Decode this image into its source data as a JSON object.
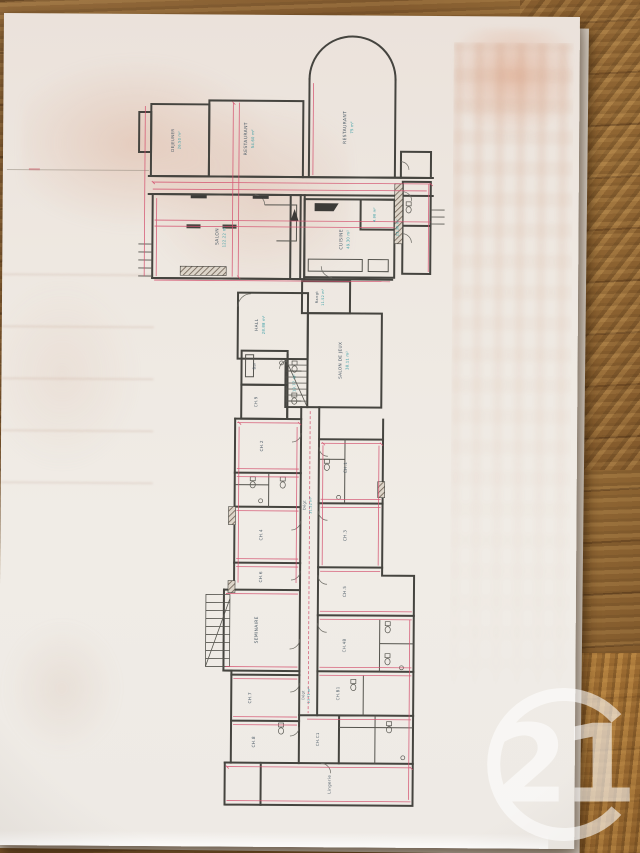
{
  "watermark": {
    "label": "21",
    "color": "#ffffff"
  },
  "plan": {
    "rooms": {
      "dejeuner": {
        "name": "DEJEUNER",
        "area": "26.50 m²"
      },
      "restaurant1": {
        "name": "RESTAURANT",
        "area": "54.60 m²"
      },
      "restaurant2": {
        "name": "RESTAURANT",
        "area": "75 m²"
      },
      "salon": {
        "name": "SALON",
        "area": "122.22 m²"
      },
      "cuisine": {
        "name": "CUISINE",
        "area": "49.30 m²"
      },
      "office_small": {
        "name": "",
        "area": "4.98 m²"
      },
      "office_corridor": {
        "name": "",
        "area": "23.36 m²"
      },
      "hall": {
        "name": "HALL",
        "area": "28.88 m²"
      },
      "rangement": {
        "name": "Rangt",
        "area": "11.52 m²"
      },
      "salon_de_jeux": {
        "name": "SALON DE JEUX",
        "area": "38.11 m²"
      },
      "degagement_escalier": {
        "name": "",
        "area": "19.77 m²"
      },
      "bar": {
        "name": "Bar"
      },
      "ch9": {
        "name": "CH.9"
      },
      "degagement_couloir": {
        "name": "Dégt",
        "area": "31.52 m²"
      },
      "ch1": {
        "name": "CH.1"
      },
      "ch2": {
        "name": "CH.2"
      },
      "ch3": {
        "name": "CH.3"
      },
      "ch4": {
        "name": "CH.4"
      },
      "ch5": {
        "name": "CH.5"
      },
      "ch6": {
        "name": "CH.6"
      },
      "seminaire": {
        "name": "SEMINAIRE"
      },
      "ch4b": {
        "name": "CH.4B"
      },
      "ch7": {
        "name": "CH.7"
      },
      "chb1": {
        "name": "CH.B1"
      },
      "ch8": {
        "name": "CH.8"
      },
      "chc1": {
        "name": "CH.C1"
      },
      "degagement_bas": {
        "name": "Dégt",
        "area": "13.71 m²"
      },
      "lingerie": {
        "name": "Lingerie"
      }
    }
  }
}
